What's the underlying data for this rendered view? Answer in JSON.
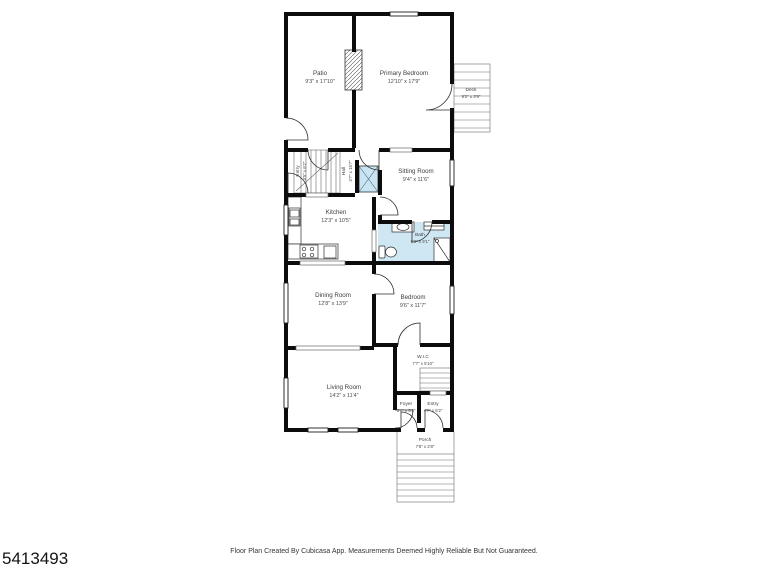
{
  "footer": {
    "photo_id": "5413493",
    "disclaimer": "Floor Plan Created By Cubicasa App. Measurements Deemed Highly Reliable But Not Guaranteed."
  },
  "floorplan": {
    "colors": {
      "wall": "#0c0c0c",
      "bath_fill": "#cfe7f3",
      "shower_fill": "#c9e4f2"
    },
    "rooms": {
      "patio": {
        "name": "Patio",
        "dims": "9'3\" x 17'10\""
      },
      "primary_bedroom": {
        "name": "Primary Bedroom",
        "dims": "12'10\" x 17'9\""
      },
      "deck": {
        "name": "Deck",
        "dims": "9'2\" x 3'9\""
      },
      "entry_upper": {
        "name": "Entry",
        "dims": "4'5\" x 6'2\""
      },
      "hall": {
        "name": "Hall",
        "dims": "3'7\" x 15'7\""
      },
      "sitting_room": {
        "name": "Sitting Room",
        "dims": "9'4\" x 11'6\""
      },
      "kitchen": {
        "name": "Kitchen",
        "dims": "12'3\" x 10'5\""
      },
      "bath": {
        "name": "Bath",
        "dims": "5'8\" x 9'1\""
      },
      "dining_room": {
        "name": "Dining Room",
        "dims": "12'8\" x 13'9\""
      },
      "bedroom": {
        "name": "Bedroom",
        "dims": "9'6\" x 11'7\""
      },
      "wic": {
        "name": "W.I.C",
        "dims": "7'7\" x 5'10\""
      },
      "living_room": {
        "name": "Living Room",
        "dims": "14'2\" x 11'4\""
      },
      "foyer": {
        "name": "Foyer",
        "dims": "3'1\" x 5'2\""
      },
      "entry": {
        "name": "Entry",
        "dims": "4'7\" x 5'2\""
      },
      "porch": {
        "name": "Porch",
        "dims": "7'8\" x 2'8\""
      }
    }
  }
}
